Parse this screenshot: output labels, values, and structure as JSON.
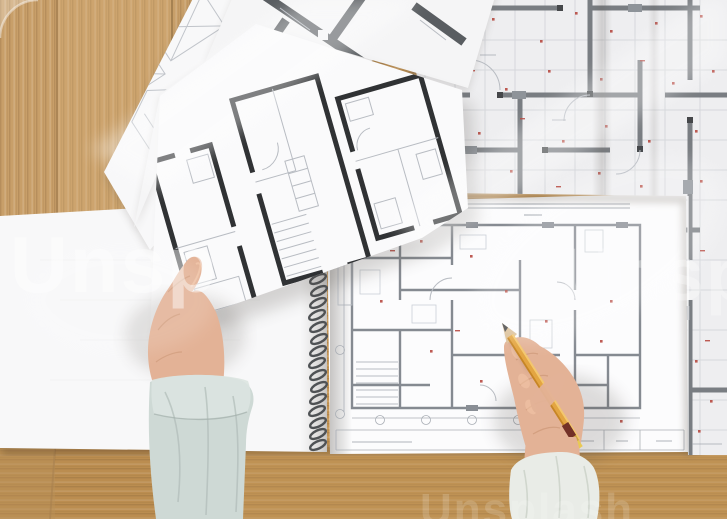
{
  "watermark": {
    "center": "Unspl",
    "left": "Unsp",
    "bottom": "Unsplash"
  },
  "colors": {
    "wood": "#c49a63",
    "wood_dark": "#9c7344",
    "wood_light": "#dab37c",
    "paper": "#f7f7f8",
    "plan_wall": "#75797e",
    "plan_black": "#2a2c2e",
    "plan_gray": "#54585c",
    "plan_line": "#b6bac1",
    "red_mark": "#b23a31",
    "skin": "#e3b093",
    "skin_shadow": "#c7906d",
    "sleeve_left": "#cdd8d4",
    "sleeve_right": "#e9ece7",
    "pencil_body": "#e3a33c",
    "pencil_band": "#6f2b21",
    "spiral": "#4a4d50"
  }
}
